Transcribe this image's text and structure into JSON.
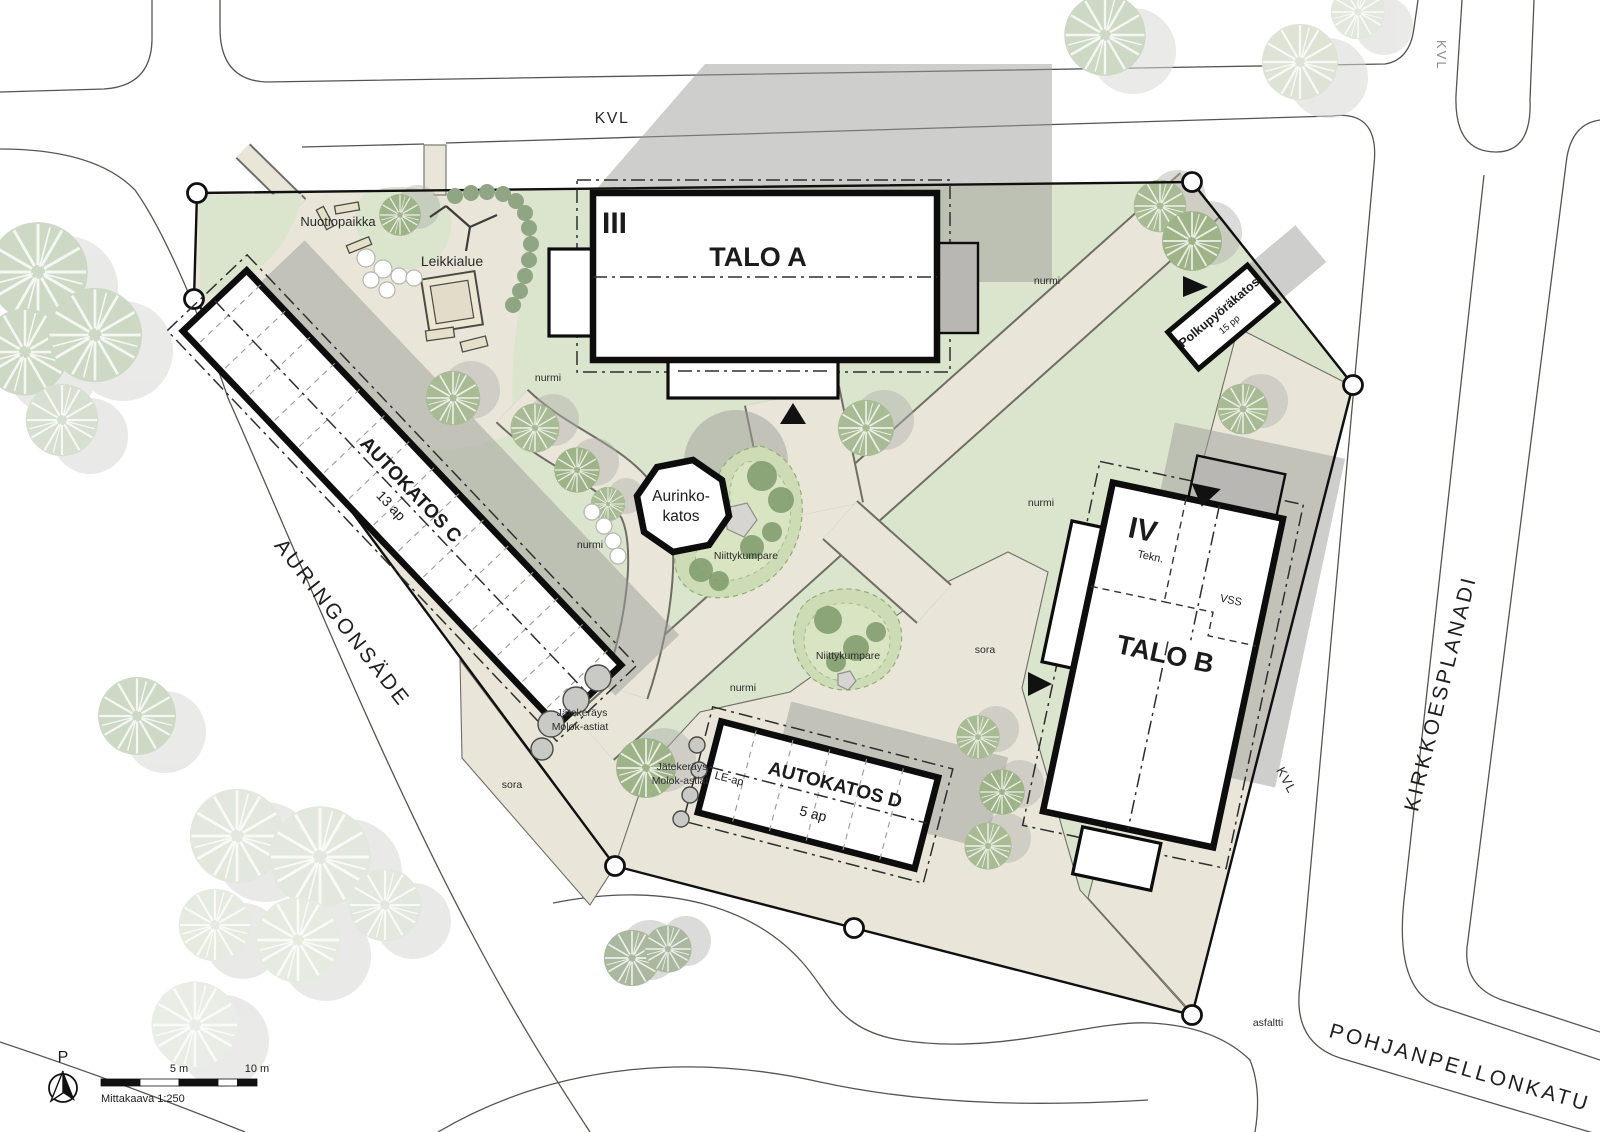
{
  "streets": {
    "kvl": "KVL",
    "auringonsade": "AURINGONSÄDE",
    "kirkkoesplanadi": "KIRKKOESPLANADI",
    "pohjanpellonkatu": "POHJANPELLONKATU"
  },
  "buildings": {
    "talo_a": {
      "name": "TALO A",
      "floors": "III"
    },
    "talo_b": {
      "name": "TALO B",
      "floors": "IV",
      "tekn": "Tekn.",
      "vss": "VSS"
    },
    "autokatos_c": {
      "name": "AUTOKATOS C",
      "capacity": "13 ap"
    },
    "autokatos_d": {
      "name": "AUTOKATOS D",
      "capacity": "5 ap",
      "le": "LE-ap"
    },
    "polkupyorakatos": {
      "name": "Polkupyöräkatos",
      "capacity": "15 pp"
    },
    "aurinkokatos": {
      "line1": "Aurinko-",
      "line2": "katos"
    }
  },
  "site": {
    "nuotiopaikka": "Nuotiopaikka",
    "leikkialue": "Leikkialue",
    "niittykumpare": "Niittykumpare",
    "jatekerays_line1": "Jätekeräys",
    "jatekerays_line2": "Molok-astiat",
    "nurmi": "nurmi",
    "sora": "sora",
    "asfaltti": "asfaltti"
  },
  "legend": {
    "north": "P",
    "scale_mid": "5 m",
    "scale_end": "10 m",
    "scale_caption": "Mittakaava 1:250"
  },
  "colors": {
    "grass": "#dbe5cd",
    "path": "#e9e6d9",
    "shadow": "#9e9e9a",
    "tree_green": "#a8bb94",
    "tree_pale": "#cdd8c5",
    "tree_faint": "#e2e8dd",
    "mound": "#cddcb4",
    "outline": "#111111",
    "street_line": "#55554f"
  }
}
